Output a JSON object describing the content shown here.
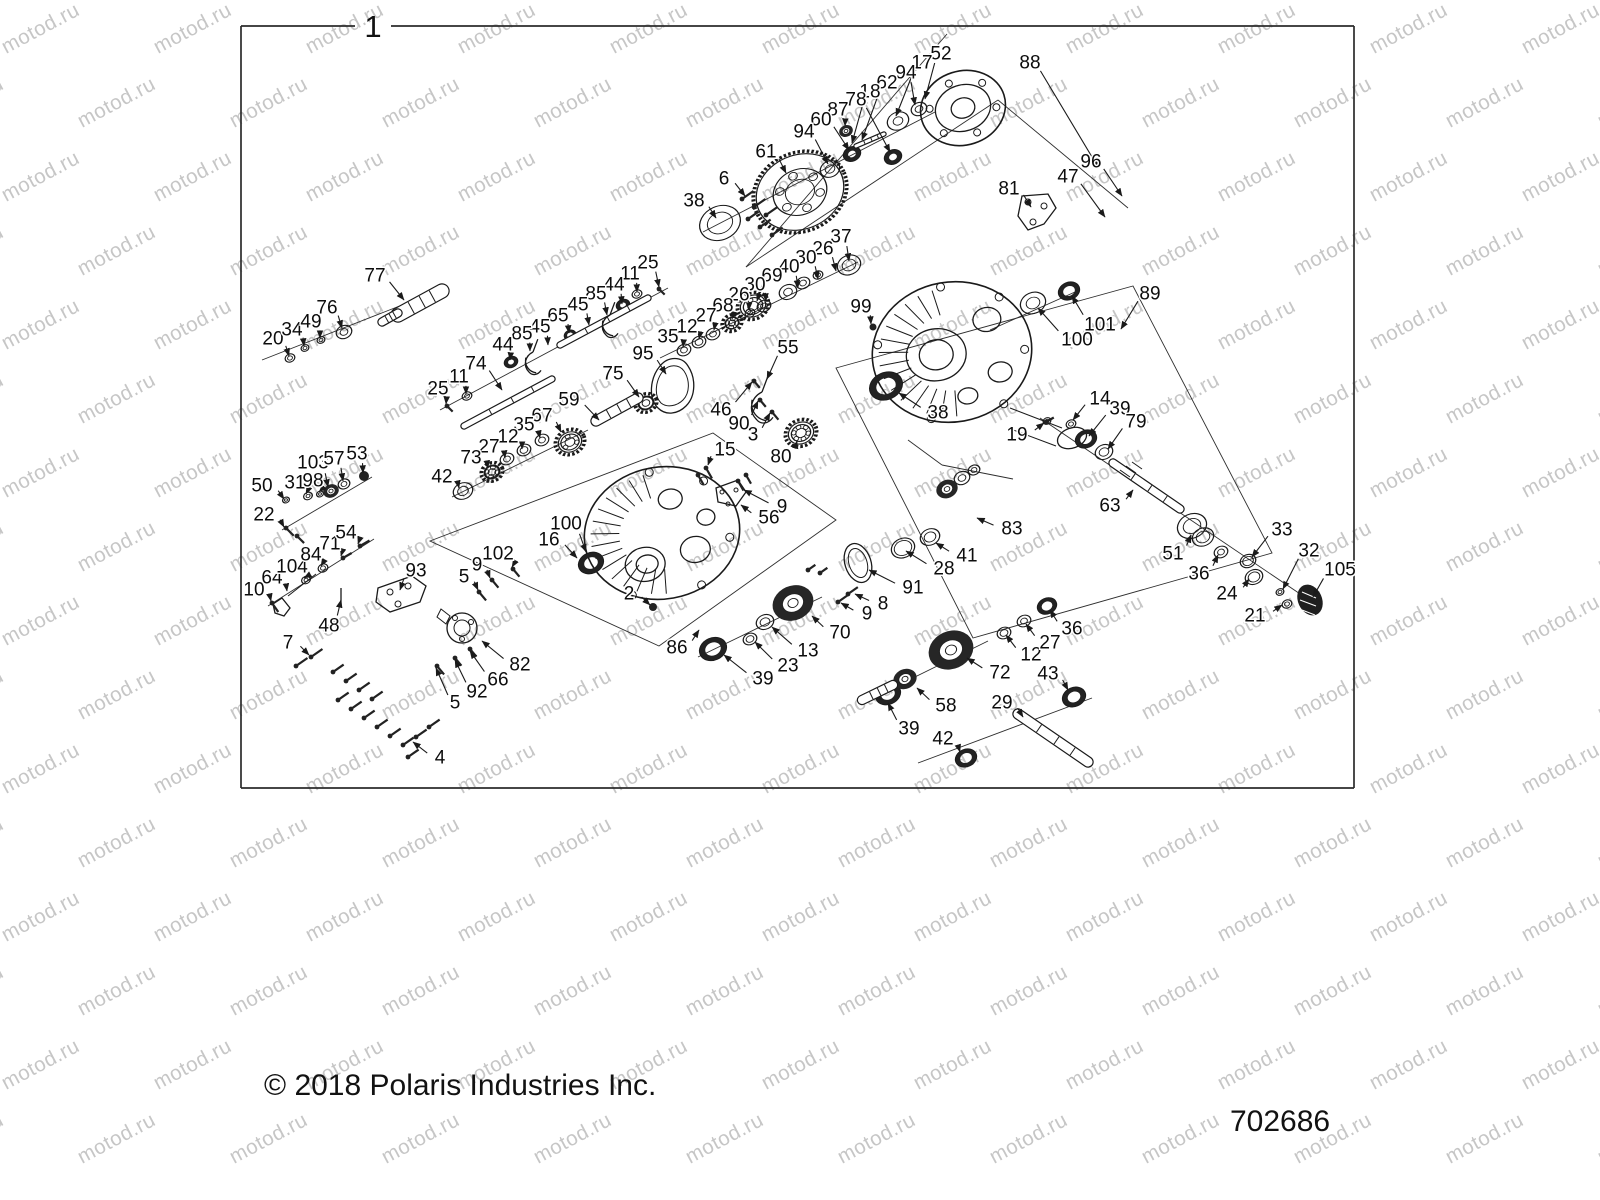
{
  "watermark": {
    "text": "motod.ru",
    "color": "#c6c6c6"
  },
  "frame": {
    "label": "1"
  },
  "footer": {
    "copyright": "© 2018 Polaris Industries Inc.",
    "part_number": "702686"
  },
  "callouts": [
    {
      "n": "88",
      "x": 1030,
      "y": 62,
      "tx": 1098,
      "ty": 167
    },
    {
      "n": "52",
      "x": 941,
      "y": 53,
      "tx": 925,
      "ty": 99
    },
    {
      "n": "17",
      "x": 922,
      "y": 62,
      "tx": 896,
      "ty": 116
    },
    {
      "n": "94",
      "x": 906,
      "y": 72,
      "tx": 915,
      "ty": 105
    },
    {
      "n": "62",
      "x": 887,
      "y": 82,
      "tx": 862,
      "ty": 140
    },
    {
      "n": "18",
      "x": 870,
      "y": 91,
      "tx": 852,
      "ty": 143
    },
    {
      "n": "78",
      "x": 856,
      "y": 99,
      "tx": 890,
      "ty": 152
    },
    {
      "n": "87",
      "x": 838,
      "y": 109,
      "tx": 845,
      "ty": 126
    },
    {
      "n": "60",
      "x": 821,
      "y": 119,
      "tx": 849,
      "ty": 150
    },
    {
      "n": "94",
      "x": 804,
      "y": 131,
      "tx": 828,
      "ty": 164
    },
    {
      "n": "61",
      "x": 766,
      "y": 151,
      "tx": 786,
      "ty": 173
    },
    {
      "n": "6",
      "x": 724,
      "y": 178,
      "tx": 745,
      "ty": 196
    },
    {
      "n": "38",
      "x": 694,
      "y": 200,
      "tx": 716,
      "ty": 218
    },
    {
      "n": "81",
      "x": 1009,
      "y": 188,
      "tx": 1031,
      "ty": 207
    },
    {
      "n": "47",
      "x": 1068,
      "y": 176,
      "tx": 1105,
      "ty": 217
    },
    {
      "n": "96",
      "x": 1091,
      "y": 161,
      "tx": 1122,
      "ty": 196
    },
    {
      "n": "25",
      "x": 648,
      "y": 262,
      "tx": 659,
      "ty": 287
    },
    {
      "n": "11",
      "x": 630,
      "y": 273,
      "tx": 637,
      "ty": 292
    },
    {
      "n": "44",
      "x": 614,
      "y": 284,
      "tx": 622,
      "ty": 304
    },
    {
      "n": "85",
      "x": 596,
      "y": 293,
      "tx": 607,
      "ty": 315
    },
    {
      "n": "45",
      "x": 578,
      "y": 304,
      "tx": 589,
      "ty": 325
    },
    {
      "n": "65",
      "x": 558,
      "y": 315,
      "tx": 569,
      "ty": 333
    },
    {
      "n": "45",
      "x": 540,
      "y": 326,
      "tx": 548,
      "ty": 345
    },
    {
      "n": "85",
      "x": 522,
      "y": 333,
      "tx": 530,
      "ty": 351
    },
    {
      "n": "44",
      "x": 503,
      "y": 344,
      "tx": 510,
      "ty": 360
    },
    {
      "n": "74",
      "x": 476,
      "y": 363,
      "tx": 502,
      "ty": 390
    },
    {
      "n": "11",
      "x": 459,
      "y": 376,
      "tx": 466,
      "ty": 394
    },
    {
      "n": "25",
      "x": 438,
      "y": 388,
      "tx": 446,
      "ty": 404
    },
    {
      "n": "95",
      "x": 643,
      "y": 353,
      "tx": 666,
      "ty": 374
    },
    {
      "n": "75",
      "x": 613,
      "y": 373,
      "tx": 639,
      "ty": 397
    },
    {
      "n": "59",
      "x": 569,
      "y": 399,
      "tx": 599,
      "ty": 420
    },
    {
      "n": "67",
      "x": 542,
      "y": 415,
      "tx": 561,
      "ty": 432
    },
    {
      "n": "35",
      "x": 524,
      "y": 424,
      "tx": 540,
      "ty": 438
    },
    {
      "n": "12",
      "x": 508,
      "y": 436,
      "tx": 522,
      "ty": 449
    },
    {
      "n": "27",
      "x": 489,
      "y": 446,
      "tx": 505,
      "ty": 458
    },
    {
      "n": "73",
      "x": 471,
      "y": 457,
      "tx": 488,
      "ty": 468
    },
    {
      "n": "42",
      "x": 442,
      "y": 476,
      "tx": 459,
      "ty": 488
    },
    {
      "n": "37",
      "x": 841,
      "y": 236,
      "tx": 849,
      "ty": 261
    },
    {
      "n": "26",
      "x": 823,
      "y": 248,
      "tx": 836,
      "ty": 271
    },
    {
      "n": "30",
      "x": 806,
      "y": 257,
      "tx": 818,
      "ty": 279
    },
    {
      "n": "40",
      "x": 789,
      "y": 266,
      "tx": 798,
      "ty": 288
    },
    {
      "n": "69",
      "x": 772,
      "y": 275,
      "tx": 757,
      "ty": 301
    },
    {
      "n": "30",
      "x": 755,
      "y": 284,
      "tx": 766,
      "ty": 301
    },
    {
      "n": "26",
      "x": 739,
      "y": 294,
      "tx": 749,
      "ty": 310
    },
    {
      "n": "68",
      "x": 723,
      "y": 305,
      "tx": 732,
      "ty": 319
    },
    {
      "n": "27",
      "x": 706,
      "y": 315,
      "tx": 714,
      "ty": 330
    },
    {
      "n": "12",
      "x": 687,
      "y": 326,
      "tx": 699,
      "ty": 339
    },
    {
      "n": "35",
      "x": 668,
      "y": 336,
      "tx": 683,
      "ty": 347
    },
    {
      "n": "99",
      "x": 861,
      "y": 306,
      "tx": 871,
      "ty": 324
    },
    {
      "n": "55",
      "x": 788,
      "y": 347,
      "tx": 767,
      "ty": 379
    },
    {
      "n": "46",
      "x": 721,
      "y": 409,
      "tx": 752,
      "ty": 382
    },
    {
      "n": "90",
      "x": 739,
      "y": 423,
      "tx": 758,
      "ty": 401
    },
    {
      "n": "3",
      "x": 753,
      "y": 434,
      "tx": 770,
      "ty": 413
    },
    {
      "n": "80",
      "x": 781,
      "y": 456,
      "tx": 797,
      "ty": 441
    },
    {
      "n": "38",
      "x": 938,
      "y": 412,
      "tx": 899,
      "ty": 393
    },
    {
      "n": "19",
      "x": 1017,
      "y": 434,
      "tx": 1044,
      "ty": 423
    },
    {
      "n": "14",
      "x": 1100,
      "y": 398,
      "tx": 1073,
      "ty": 420
    },
    {
      "n": "39",
      "x": 1120,
      "y": 408,
      "tx": 1089,
      "ty": 436
    },
    {
      "n": "79",
      "x": 1136,
      "y": 421,
      "tx": 1108,
      "ty": 449
    },
    {
      "n": "89",
      "x": 1150,
      "y": 293,
      "tx": 1121,
      "ty": 329
    },
    {
      "n": "101",
      "x": 1100,
      "y": 324,
      "tx": 1072,
      "ty": 296
    },
    {
      "n": "100",
      "x": 1077,
      "y": 339,
      "tx": 1038,
      "ty": 308
    },
    {
      "n": "15",
      "x": 725,
      "y": 449,
      "tx": 708,
      "ty": 465
    },
    {
      "n": "9",
      "x": 782,
      "y": 506,
      "tx": 744,
      "ty": 490
    },
    {
      "n": "56",
      "x": 769,
      "y": 517,
      "tx": 741,
      "ty": 505
    },
    {
      "n": "100",
      "x": 566,
      "y": 523,
      "tx": 586,
      "ty": 552
    },
    {
      "n": "16",
      "x": 549,
      "y": 539,
      "tx": 577,
      "ty": 558
    },
    {
      "n": "102",
      "x": 498,
      "y": 553,
      "tx": 512,
      "ty": 567
    },
    {
      "n": "9",
      "x": 477,
      "y": 564,
      "tx": 490,
      "ty": 578
    },
    {
      "n": "5",
      "x": 464,
      "y": 576,
      "tx": 478,
      "ty": 590
    },
    {
      "n": "2",
      "x": 629,
      "y": 593,
      "tx": 650,
      "ty": 605
    },
    {
      "n": "86",
      "x": 677,
      "y": 647,
      "tx": 699,
      "ty": 630
    },
    {
      "n": "82",
      "x": 520,
      "y": 664,
      "tx": 482,
      "ty": 641
    },
    {
      "n": "66",
      "x": 498,
      "y": 679,
      "tx": 470,
      "ty": 651
    },
    {
      "n": "92",
      "x": 477,
      "y": 691,
      "tx": 455,
      "ty": 660
    },
    {
      "n": "5",
      "x": 455,
      "y": 702,
      "tx": 436,
      "ty": 668
    },
    {
      "n": "4",
      "x": 440,
      "y": 757,
      "tx": 413,
      "ty": 742
    },
    {
      "n": "7",
      "x": 288,
      "y": 642,
      "tx": 309,
      "ty": 655
    },
    {
      "n": "10",
      "x": 254,
      "y": 589,
      "tx": 271,
      "ty": 601
    },
    {
      "n": "64",
      "x": 272,
      "y": 577,
      "tx": 287,
      "ty": 591
    },
    {
      "n": "104",
      "x": 292,
      "y": 566,
      "tx": 304,
      "ty": 578
    },
    {
      "n": "84",
      "x": 311,
      "y": 554,
      "tx": 321,
      "ty": 566
    },
    {
      "n": "71",
      "x": 330,
      "y": 543,
      "tx": 341,
      "ty": 556
    },
    {
      "n": "54",
      "x": 346,
      "y": 532,
      "tx": 358,
      "ty": 544
    },
    {
      "n": "48",
      "x": 329,
      "y": 625,
      "tx": 341,
      "ty": 600
    },
    {
      "n": "93",
      "x": 416,
      "y": 570,
      "tx": 400,
      "ty": 590
    },
    {
      "n": "22",
      "x": 264,
      "y": 514,
      "tx": 284,
      "ty": 527
    },
    {
      "n": "50",
      "x": 262,
      "y": 485,
      "tx": 284,
      "ty": 499
    },
    {
      "n": "31",
      "x": 295,
      "y": 482,
      "tx": 306,
      "ty": 494
    },
    {
      "n": "98",
      "x": 313,
      "y": 480,
      "tx": 319,
      "ty": 492
    },
    {
      "n": "103",
      "x": 313,
      "y": 462,
      "tx": 328,
      "ty": 487
    },
    {
      "n": "57",
      "x": 334,
      "y": 458,
      "tx": 343,
      "ty": 481
    },
    {
      "n": "53",
      "x": 357,
      "y": 453,
      "tx": 363,
      "ty": 473
    },
    {
      "n": "20",
      "x": 273,
      "y": 338,
      "tx": 289,
      "ty": 356
    },
    {
      "n": "34",
      "x": 292,
      "y": 329,
      "tx": 304,
      "ty": 346
    },
    {
      "n": "49",
      "x": 311,
      "y": 321,
      "tx": 320,
      "ty": 338
    },
    {
      "n": "76",
      "x": 327,
      "y": 307,
      "tx": 342,
      "ty": 328
    },
    {
      "n": "77",
      "x": 375,
      "y": 275,
      "tx": 404,
      "ty": 300
    },
    {
      "n": "70",
      "x": 840,
      "y": 632,
      "tx": 812,
      "ty": 616
    },
    {
      "n": "13",
      "x": 808,
      "y": 650,
      "tx": 772,
      "ty": 627
    },
    {
      "n": "23",
      "x": 788,
      "y": 665,
      "tx": 755,
      "ty": 642
    },
    {
      "n": "39",
      "x": 763,
      "y": 678,
      "tx": 724,
      "ty": 655
    },
    {
      "n": "8",
      "x": 883,
      "y": 603,
      "tx": 855,
      "ty": 594
    },
    {
      "n": "9",
      "x": 867,
      "y": 613,
      "tx": 841,
      "ty": 603
    },
    {
      "n": "91",
      "x": 913,
      "y": 587,
      "tx": 869,
      "ty": 570
    },
    {
      "n": "28",
      "x": 944,
      "y": 568,
      "tx": 906,
      "ty": 551
    },
    {
      "n": "41",
      "x": 967,
      "y": 555,
      "tx": 936,
      "ty": 543
    },
    {
      "n": "83",
      "x": 1012,
      "y": 528,
      "tx": 977,
      "ty": 518
    },
    {
      "n": "58",
      "x": 946,
      "y": 705,
      "tx": 917,
      "ty": 688
    },
    {
      "n": "29",
      "x": 1002,
      "y": 702,
      "tx": 1023,
      "ty": 717
    },
    {
      "n": "39",
      "x": 909,
      "y": 728,
      "tx": 888,
      "ty": 703
    },
    {
      "n": "42",
      "x": 943,
      "y": 738,
      "tx": 960,
      "ty": 752
    },
    {
      "n": "72",
      "x": 1000,
      "y": 672,
      "tx": 967,
      "ty": 658
    },
    {
      "n": "12",
      "x": 1031,
      "y": 654,
      "tx": 1006,
      "ty": 635
    },
    {
      "n": "27",
      "x": 1050,
      "y": 642,
      "tx": 1026,
      "ty": 624
    },
    {
      "n": "36",
      "x": 1072,
      "y": 628,
      "tx": 1050,
      "ty": 610
    },
    {
      "n": "43",
      "x": 1048,
      "y": 673,
      "tx": 1068,
      "ty": 690
    },
    {
      "n": "63",
      "x": 1110,
      "y": 505,
      "tx": 1133,
      "ty": 490
    },
    {
      "n": "51",
      "x": 1173,
      "y": 553,
      "tx": 1191,
      "ty": 535
    },
    {
      "n": "36",
      "x": 1199,
      "y": 573,
      "tx": 1218,
      "ty": 555
    },
    {
      "n": "33",
      "x": 1282,
      "y": 529,
      "tx": 1252,
      "ty": 557
    },
    {
      "n": "24",
      "x": 1227,
      "y": 593,
      "tx": 1249,
      "ty": 579
    },
    {
      "n": "32",
      "x": 1309,
      "y": 550,
      "tx": 1283,
      "ty": 589
    },
    {
      "n": "21",
      "x": 1255,
      "y": 615,
      "tx": 1282,
      "ty": 605
    },
    {
      "n": "105",
      "x": 1340,
      "y": 569,
      "tx": 1313,
      "ty": 597
    }
  ]
}
